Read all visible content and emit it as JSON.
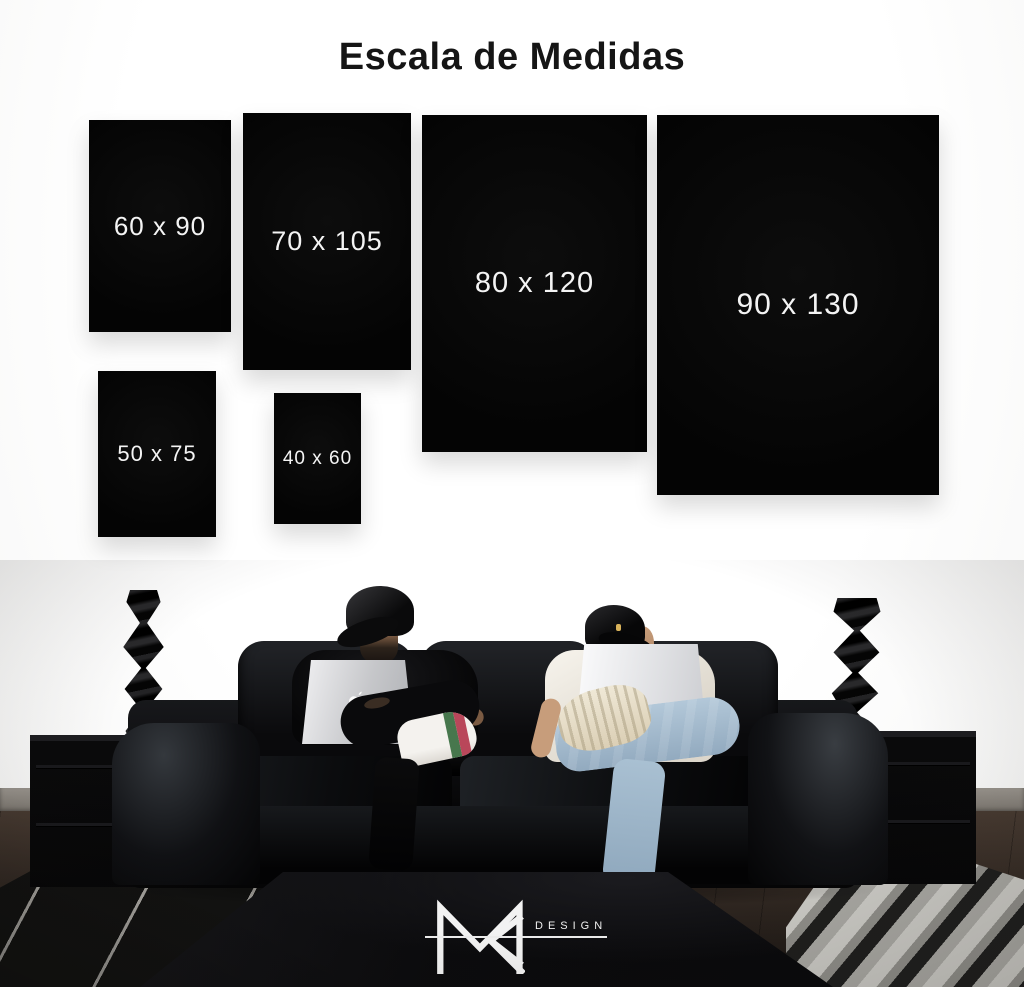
{
  "title": "Escala de Medidas",
  "size_cards": [
    {
      "label": "60 x 90"
    },
    {
      "label": "70 x 105"
    },
    {
      "label": "80 x 120"
    },
    {
      "label": "90 x 130"
    },
    {
      "label": "50 x 75"
    },
    {
      "label": "40 x 60"
    }
  ],
  "brand": {
    "monogram": "MR",
    "wordmark": "DESIGN"
  },
  "scene": {
    "icons": [
      "apple-logo-icon",
      "apple-logo-icon",
      "mr-monogram-icon"
    ],
    "objects": [
      "black-leather-sofa",
      "man-black-cap-macbook-left",
      "man-white-tee-macbook-right",
      "twisted-sculpture-left",
      "twisted-sculpture-right",
      "black-side-table-left",
      "black-side-table-right",
      "black-coffee-table",
      "striped-black-rug-left",
      "shag-grey-rug-right"
    ],
    "colors": {
      "panel_black": "#060606",
      "label_white": "#f4f4f4",
      "wall": "#fbfbfa",
      "baseboard_grey": "#8d8881",
      "floor_brown": "#3a3028",
      "sofa_black": "#0b0c0e",
      "jeans_blue": "#a9c0d4",
      "tee_white": "#f2efe8",
      "sneaker_cream": "#e9e2d0",
      "sneaker_green": "#47774d",
      "sneaker_red": "#b9475a",
      "macbook_silver": "#d8d9db",
      "logo_white": "#f0f0f0"
    }
  }
}
